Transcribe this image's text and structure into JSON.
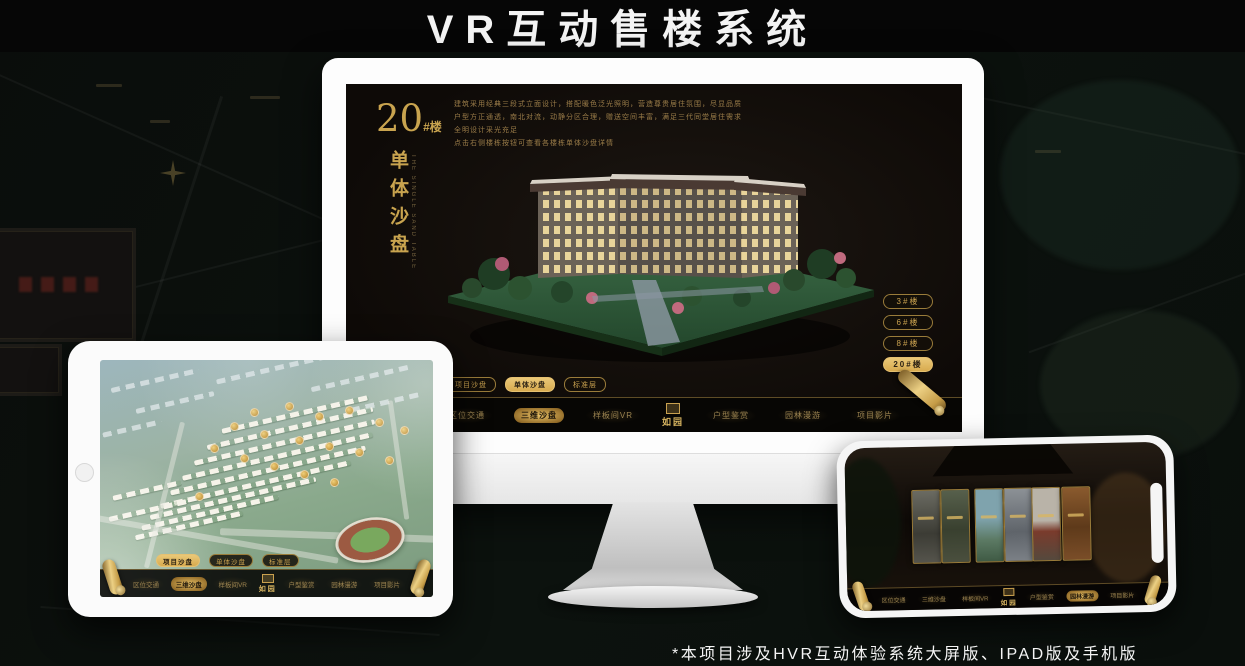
{
  "page": {
    "title": "VR互动售楼系统",
    "footnote": "*本项目涉及HVR互动体验系统大屏版、IPAD版及手机版"
  },
  "brand": {
    "name": "如园"
  },
  "colors": {
    "gold": "#C9A14F",
    "gold_bright": "#E8C877",
    "active_tab_bg": "#DFB25C",
    "screen_bg": "#120E0A"
  },
  "monitor_app": {
    "hero": {
      "number": "20",
      "suffix": "#楼",
      "subtitle": "单体沙盘",
      "subtitle_en": "THE SINGLE SAND TABLE"
    },
    "description_lines": [
      "建筑采用经典三段式立面设计，搭配暖色泛光照明，营造尊贵居住氛围，尽显品质",
      "户型方正通透，南北对流，动静分区合理，赠送空间丰富，满足三代同堂居住需求",
      "全明设计采光充足",
      "点击右侧楼栋按钮可查看各楼栋单体沙盘详情"
    ],
    "building_buttons": [
      {
        "label": "3#楼",
        "active": false
      },
      {
        "label": "6#楼",
        "active": false
      },
      {
        "label": "8#楼",
        "active": false
      },
      {
        "label": "20#楼",
        "active": true
      }
    ],
    "sub_tabs": [
      {
        "label": "项目沙盘",
        "active": false
      },
      {
        "label": "单体沙盘",
        "active": true
      },
      {
        "label": "标准层",
        "active": false
      }
    ],
    "nav_items": [
      {
        "label": "区位交通",
        "active": false
      },
      {
        "label": "三维沙盘",
        "active": true
      },
      {
        "label": "样板间VR",
        "active": false
      },
      {
        "label": "户型鉴赏",
        "active": false
      },
      {
        "label": "园林漫游",
        "active": false
      },
      {
        "label": "项目影片",
        "active": false
      }
    ]
  },
  "ipad_app": {
    "sub_tabs": [
      {
        "label": "项目沙盘",
        "active": true
      },
      {
        "label": "单体沙盘",
        "active": false
      },
      {
        "label": "标准层",
        "active": false
      }
    ],
    "nav_items": [
      {
        "label": "区位交通",
        "active": false
      },
      {
        "label": "三维沙盘",
        "active": true
      },
      {
        "label": "样板间VR",
        "active": false
      },
      {
        "label": "户型鉴赏",
        "active": false
      },
      {
        "label": "园林漫游",
        "active": false
      },
      {
        "label": "项目影片",
        "active": false
      }
    ]
  },
  "phone_app": {
    "nav_items": [
      {
        "label": "区位交通",
        "active": false
      },
      {
        "label": "三维沙盘",
        "active": false
      },
      {
        "label": "样板间VR",
        "active": false
      },
      {
        "label": "户型鉴赏",
        "active": false
      },
      {
        "label": "园林漫游",
        "active": true
      },
      {
        "label": "项目影片",
        "active": false
      }
    ],
    "gallery_panel_count": "6"
  }
}
